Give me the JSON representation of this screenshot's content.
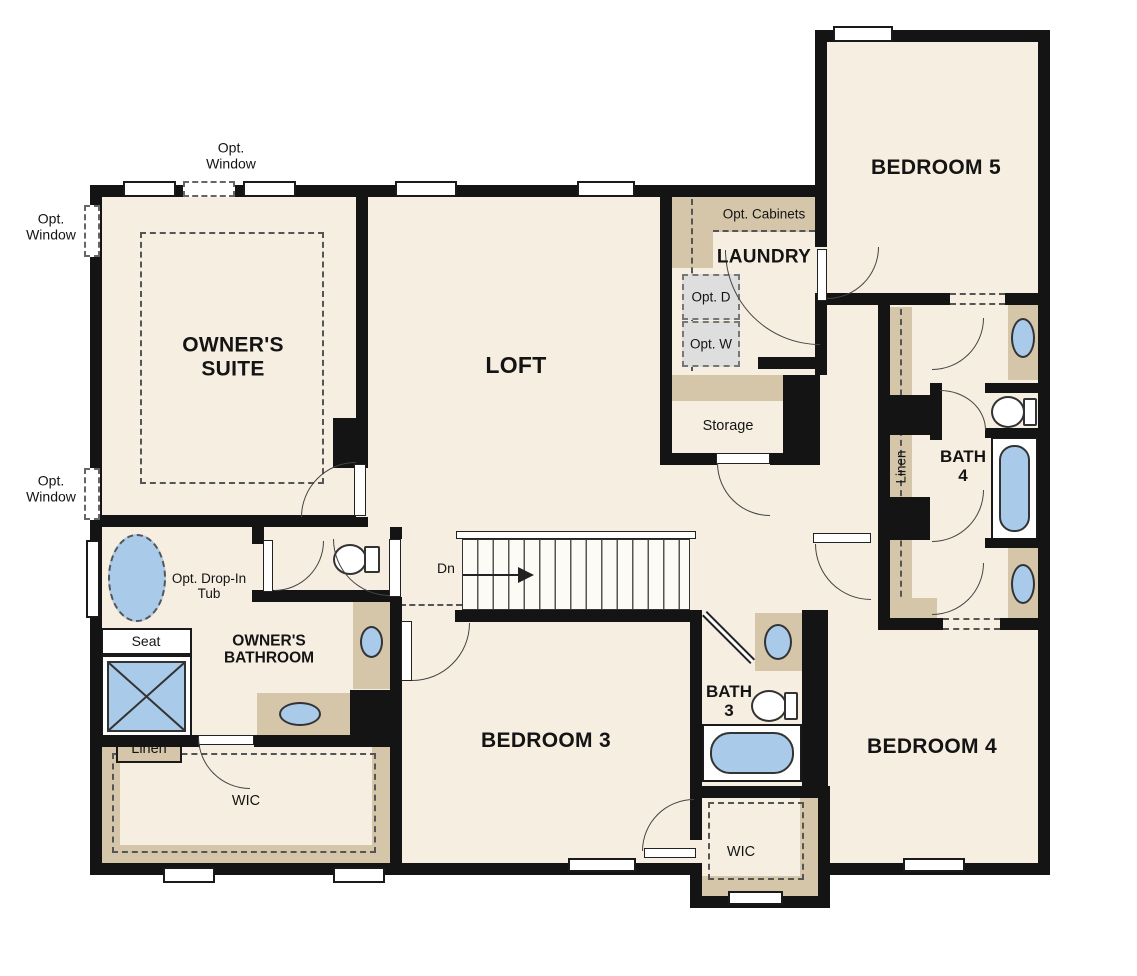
{
  "colors": {
    "floor": "#f6eee1",
    "wall": "#141414",
    "cabinet_tan": "#d5c6aa",
    "fixture_blue": "#a9cbe9",
    "optional_gray": "#dedede"
  },
  "rooms": {
    "owners_suite": "OWNER'S SUITE",
    "loft": "LOFT",
    "laundry": "LAUNDRY",
    "bedroom5": "BEDROOM 5",
    "bedroom3": "BEDROOM 3",
    "bedroom4": "BEDROOM 4",
    "owners_bathroom": "OWNER'S BATHROOM",
    "bath3": "BATH 3",
    "bath4": "BATH 4",
    "storage": "Storage",
    "wic_owners": "WIC",
    "wic_hall": "WIC",
    "linen_owners": "Linen",
    "linen_hall": "Linen"
  },
  "annotations": {
    "opt_window_top": "Opt. Window",
    "opt_window_left_upper": "Opt. Window",
    "opt_window_left_lower": "Opt. Window",
    "opt_cabinets": "Opt. Cabinets",
    "opt_dryer": "Opt. D",
    "opt_washer": "Opt. W",
    "opt_drop_in_tub": "Opt. Drop-In Tub",
    "shower_seat": "Seat",
    "stairs_direction": "Dn"
  }
}
